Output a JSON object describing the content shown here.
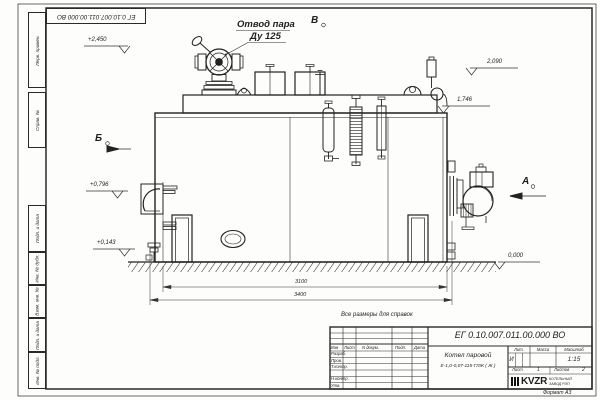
{
  "sheet": {
    "stamp_top_left": "ЕГ 0.10.007.011.00.000  ВО",
    "margin_labels": [
      "Перв. примен.",
      "Справ. №",
      "Подп. и дата",
      "Инв. № дубл.",
      "Взам. инв. №",
      "Подп. и дата",
      "Инв. № подл."
    ],
    "note": "Все размеры для справок",
    "format_label": "Формат А3"
  },
  "drawing": {
    "callout": {
      "line1": "Отвод пара",
      "line2": "Ду 125"
    },
    "view_markers": {
      "b": "Б",
      "v": "В",
      "a": "А"
    },
    "levels": {
      "left_top": "+2,450",
      "left_mid": "+0,796",
      "left_low": "+0,143",
      "right_top": "2,090",
      "right_mid": "1,746",
      "ground": "0,000"
    },
    "dims": {
      "inner": "3100",
      "outer": "3400"
    }
  },
  "title_block": {
    "designation": "ЕГ 0.10.007.011.00.000  ВО",
    "product_name_line1": "Котел паровой",
    "product_name_line2": "Е-1,0-0,07-115-ГЛЖ ( Ж )",
    "header_cols": {
      "izm": "Изм",
      "list": "Лист",
      "doc": "N докум.",
      "podp": "Подп.",
      "data": "Дата"
    },
    "rows": [
      "Разраб.",
      "Пров.",
      "Т.контр.",
      "Н.контр.",
      "Утв."
    ],
    "lit_label": "Лит.",
    "lit_value": "И",
    "massa_label": "Масса",
    "scale_label": "Масштаб",
    "scale_value": "1:15",
    "sheet_label": "Лист",
    "sheet_value": "1",
    "sheets_label": "Листов",
    "sheets_value": "2",
    "logo_text": "KVZR",
    "company_line1": "КОТЕЛЬНЫЙ",
    "company_line2": "ЗАВОД РЭП"
  }
}
